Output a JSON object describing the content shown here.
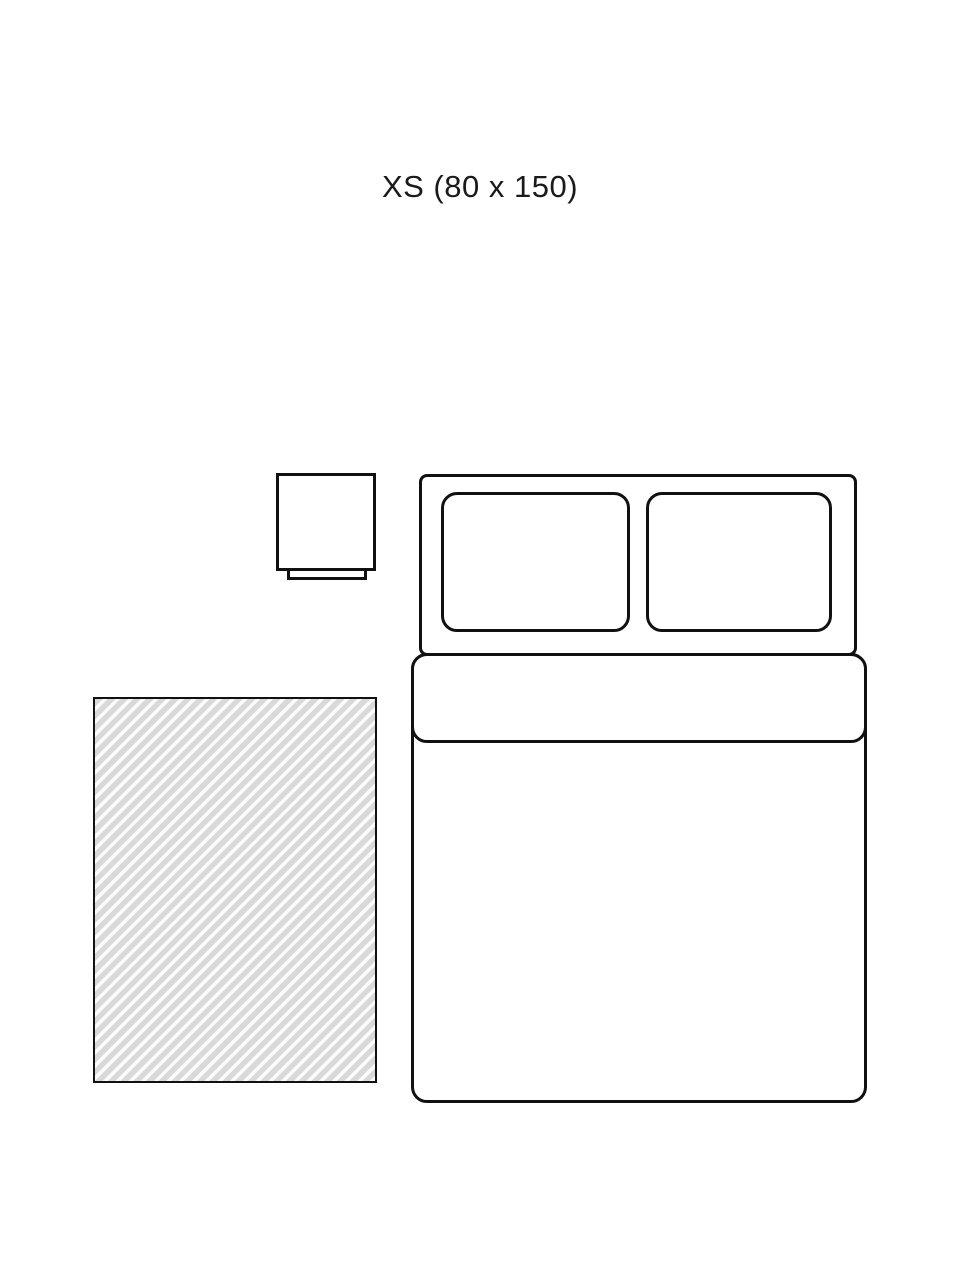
{
  "page": {
    "background": "#ffffff"
  },
  "colors": {
    "background": "#ffffff",
    "line": "#111111",
    "text": "#1a1a1a",
    "rug_stripe": "#d9d9d9",
    "rug_gap": "#fcfcfc"
  },
  "diagram": {
    "title": "XS (80 x 150)",
    "size_code": "XS",
    "rug_dimensions": "80 x 150",
    "elements": [
      {
        "name": "nightstand-icon",
        "description": "top-down nightstand outline"
      },
      {
        "name": "bed-icon",
        "description": "top-down double bed with two pillows and folded duvet"
      },
      {
        "name": "rug-swatch",
        "description": "hatched rectangle showing rug footprint"
      }
    ]
  }
}
